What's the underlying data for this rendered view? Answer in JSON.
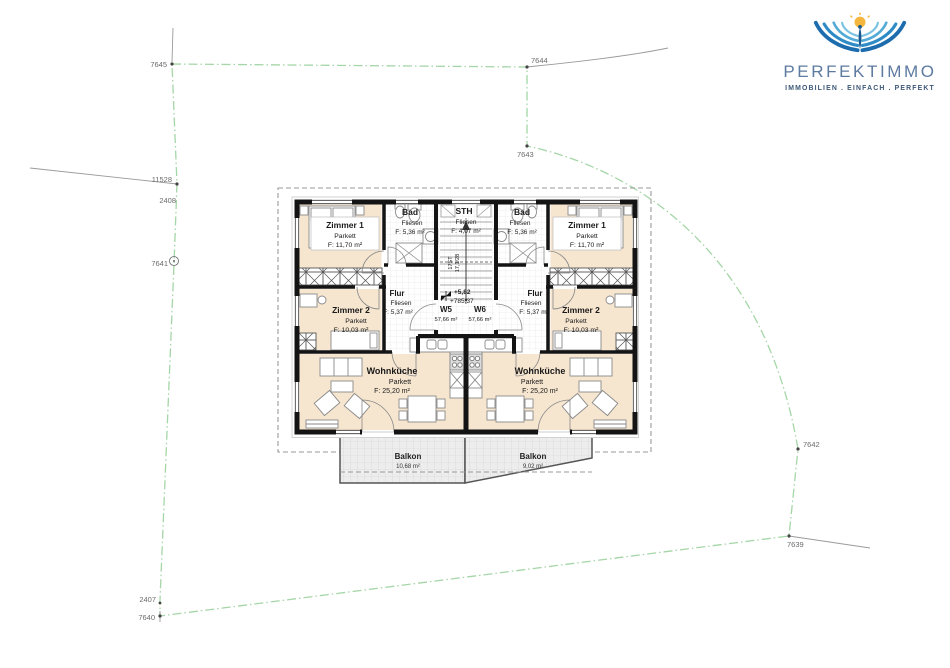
{
  "logo": {
    "brand": "PERFEKTIMMO",
    "tagline": "IMMOBILIEN . EINFACH . PERFEKT"
  },
  "site": {
    "parcel_labels": [
      "7645",
      "7644",
      "7643",
      "11528",
      "2408",
      "7641",
      "7642",
      "7639",
      "2407",
      "7640"
    ]
  },
  "plan": {
    "units": [
      {
        "id": "W5",
        "area": "57,66 m²"
      },
      {
        "id": "W6",
        "area": "57,66 m²"
      }
    ],
    "stair": {
      "steps": "17ST",
      "ratio": "17,1/28",
      "level_upper": "+5,82",
      "level_absolute": "+785,37"
    },
    "rooms": {
      "z1l": {
        "name": "Zimmer 1",
        "finish": "Parkett",
        "area": "F:  11,70 m²"
      },
      "badl": {
        "name": "Bad",
        "finish": "Fliesen",
        "area": "F: 5,36 m²"
      },
      "z2l": {
        "name": "Zimmer 2",
        "finish": "Parkett",
        "area": "F:  10,03 m²"
      },
      "flurl": {
        "name": "Flur",
        "finish": "Fliesen",
        "area": "F: 5,37 m²"
      },
      "wkl": {
        "name": "Wohnküche",
        "finish": "Parkett",
        "area": "F:   25,20 m²"
      },
      "sth": {
        "name": "STH",
        "finish": "Fliesen",
        "area": "F: 4,07 m²"
      },
      "badr": {
        "name": "Bad",
        "finish": "Fliesen",
        "area": "F: 5,36 m²"
      },
      "z1r": {
        "name": "Zimmer 1",
        "finish": "Parkett",
        "area": "F:  11,70 m²"
      },
      "flurr": {
        "name": "Flur",
        "finish": "Fliesen",
        "area": "F: 5,37 m²"
      },
      "z2r": {
        "name": "Zimmer 2",
        "finish": "Parkett",
        "area": "F:  10,03 m²"
      },
      "wkr": {
        "name": "Wohnküche",
        "finish": "Parkett",
        "area": "F:   25,20 m²"
      }
    },
    "balconies": [
      {
        "name": "Balkon",
        "area": "10,68 m²"
      },
      {
        "name": "Balkon",
        "area": "9,02 m²"
      }
    ]
  },
  "colors": {
    "boundary_green": "#a5d6a7",
    "room_fill": "#f6e6d0",
    "wall": "#111111",
    "balcony_fill": "#ededed",
    "logo_blue": "#5d7aa0",
    "logo_dark_blue": "#3d5877",
    "wing_blue": "#1c6cae",
    "sun_yellow": "#f4b63c"
  }
}
